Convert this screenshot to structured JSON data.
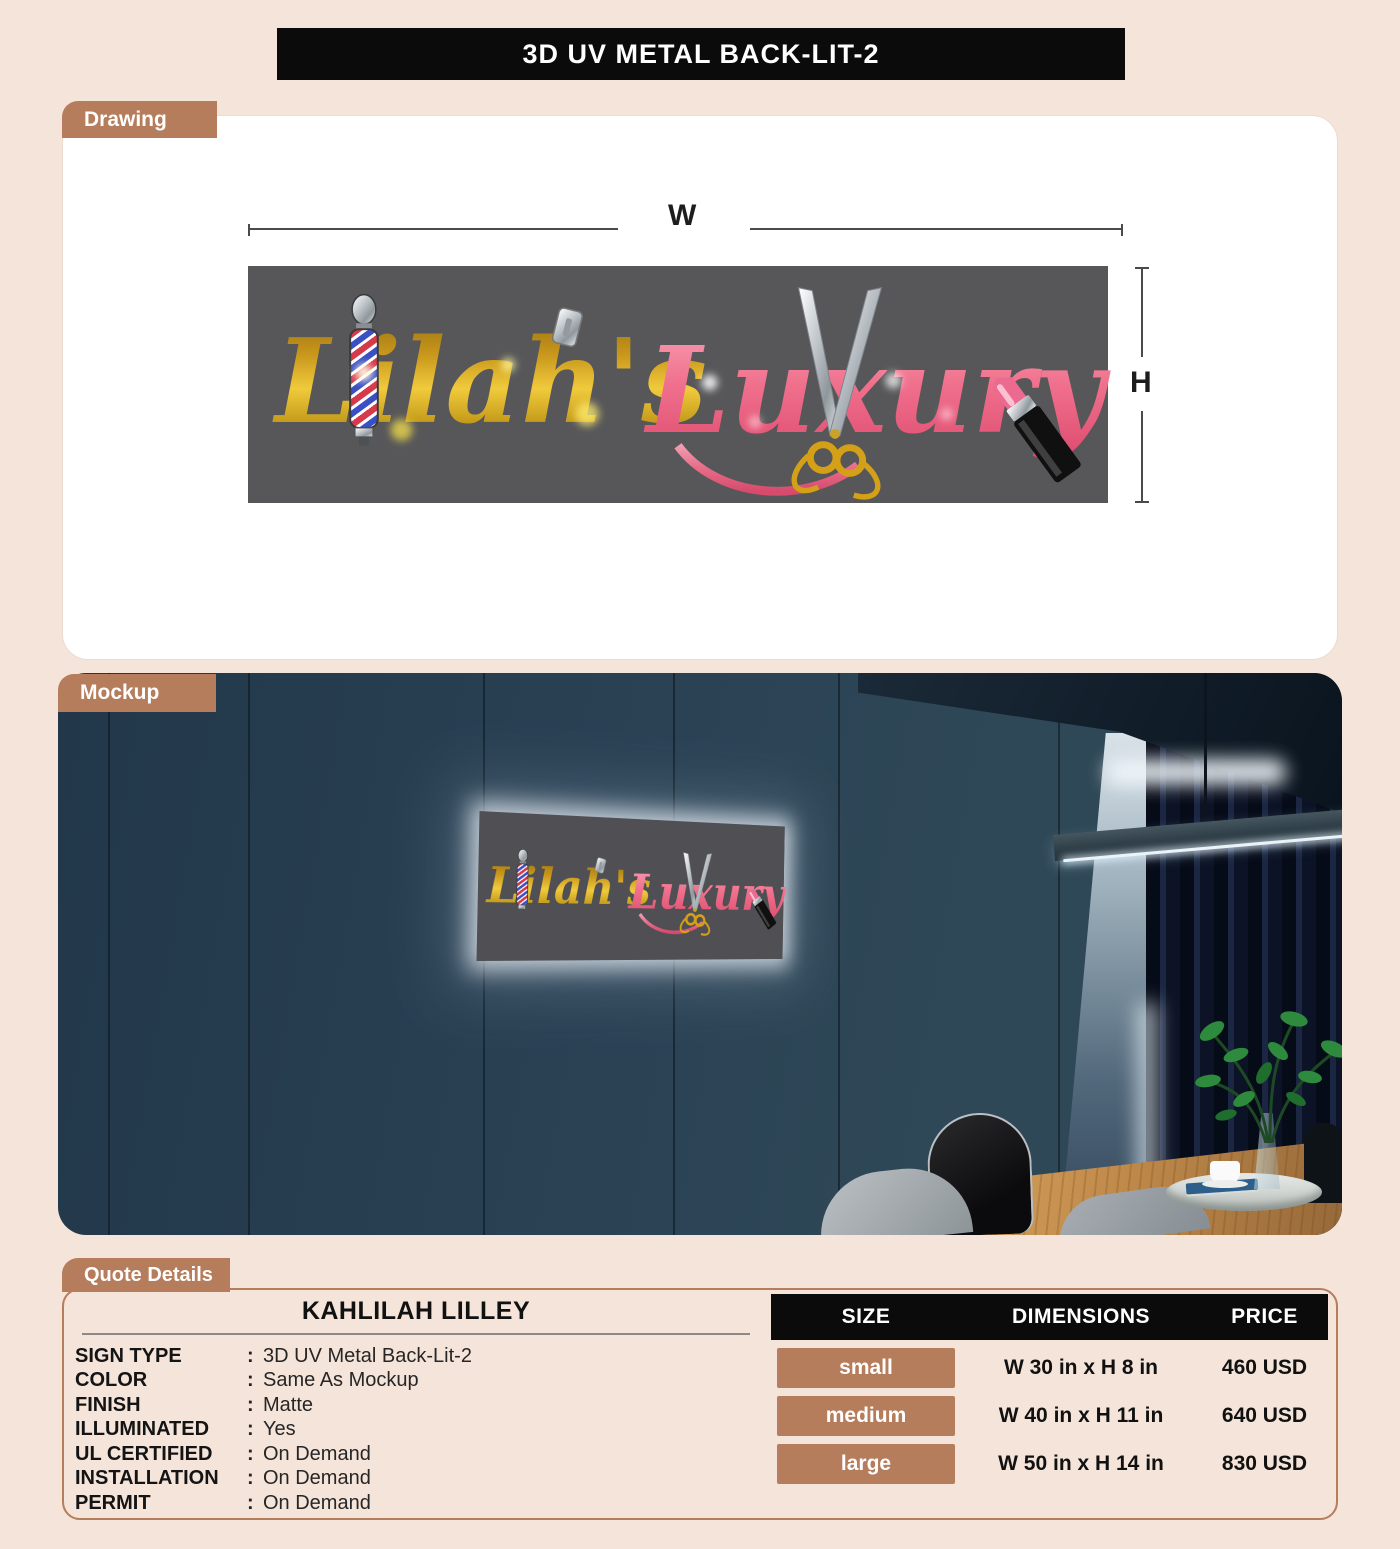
{
  "page": {
    "title": "3D UV METAL BACK-LIT-2"
  },
  "sections": {
    "drawing": "Drawing",
    "mockup": "Mockup",
    "quote": "Quote Details"
  },
  "drawing": {
    "width_label": "W",
    "height_label": "H"
  },
  "logo": {
    "word1": "Lilah's",
    "word2": "Luxury"
  },
  "quote": {
    "customer": "KAHLILAH LILLEY",
    "separator": ":",
    "specs": [
      {
        "label": "SIGN TYPE",
        "value": "3D UV Metal Back-Lit-2"
      },
      {
        "label": "COLOR",
        "value": "Same As Mockup"
      },
      {
        "label": "FINISH",
        "value": "Matte"
      },
      {
        "label": "ILLUMINATED",
        "value": "Yes"
      },
      {
        "label": "UL CERTIFIED",
        "value": "On Demand"
      },
      {
        "label": "INSTALLATION",
        "value": "On Demand"
      },
      {
        "label": "PERMIT",
        "value": "On Demand"
      }
    ],
    "pricing": {
      "headers": [
        "SIZE",
        "DIMENSIONS",
        "PRICE"
      ],
      "rows": [
        {
          "size": "small",
          "dimensions": "W 30 in x H 8 in",
          "price": "460 USD"
        },
        {
          "size": "medium",
          "dimensions": "W 40 in x H 11 in",
          "price": "640 USD"
        },
        {
          "size": "large",
          "dimensions": "W 50 in x H 14 in",
          "price": "830 USD"
        }
      ]
    }
  },
  "colors": {
    "background": "#f5e4da",
    "accent": "#b67d5c",
    "title_bar": "#0b0b0b",
    "sign_gray": "#57575a",
    "gold": "#d4a017",
    "pink": "#f0718d"
  }
}
